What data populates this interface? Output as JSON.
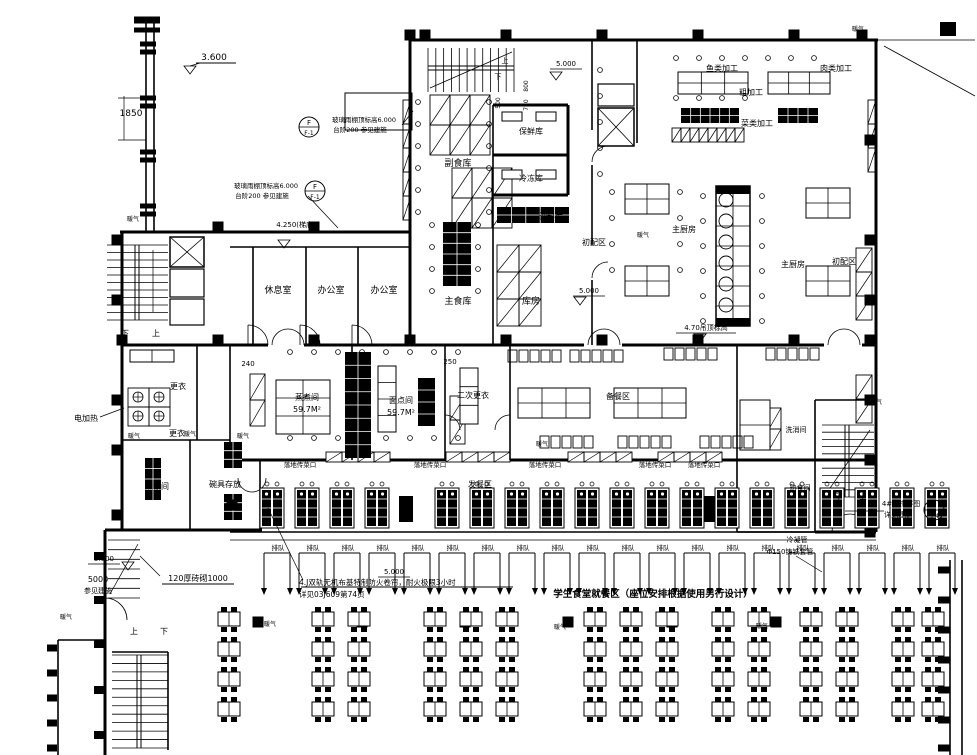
{
  "drawing": {
    "kind": "architectural floor plan (cafeteria / kitchen CAD drawing)",
    "line_color": "#000000",
    "background_color": "#ffffff"
  },
  "notes": {
    "fire_curtain_line1": "4.J双轨无机布基特制防火卷帘，耐火极限3小时",
    "fire_curtain_line2": "详见03J609第74页",
    "dining_area": "学生食堂就餐区（座位安排根据使用另行设计）"
  },
  "symbols": {
    "detail_circles": [
      {
        "top": "F",
        "bottom": "F-1",
        "x": 309,
        "y": 127
      },
      {
        "top": "F",
        "bottom": "F-1",
        "x": 315,
        "y": 191
      },
      {
        "top": "",
        "bottom": "3-4",
        "x": 934,
        "y": 510
      }
    ],
    "level_markers": [
      {
        "x": 190,
        "y": 66
      },
      {
        "x": 556,
        "y": 72
      },
      {
        "x": 580,
        "y": 297
      },
      {
        "x": 700,
        "y": 334
      },
      {
        "x": 128,
        "y": 562
      },
      {
        "x": 284,
        "y": 240
      }
    ]
  },
  "repeated": {
    "queue": {
      "label": "排队",
      "count": 20
    },
    "serving_stations": {
      "count": 19
    },
    "serving_windows": {
      "label": "落地传菜口",
      "count": 5
    },
    "dining_tables": {
      "clusters": 7,
      "rows": 4,
      "seats_per_table": 4
    }
  },
  "labels": [
    {
      "t": "3.600",
      "x": 214,
      "y": 60,
      "s": 9
    },
    {
      "t": "1850",
      "x": 131,
      "y": 116,
      "s": 9
    },
    {
      "t": "玻璃雨棚顶标高6.000",
      "x": 364,
      "y": 122,
      "s": 6.5
    },
    {
      "t": "台阶200  参见建施",
      "x": 360,
      "y": 132,
      "s": 6.5
    },
    {
      "t": "玻璃雨棚顶标高6.000",
      "x": 266,
      "y": 188,
      "s": 6.5
    },
    {
      "t": "台阶200  参见建施",
      "x": 262,
      "y": 198,
      "s": 6.5
    },
    {
      "t": "4.250(梯底)",
      "x": 296,
      "y": 227,
      "s": 7
    },
    {
      "t": "休息室",
      "x": 278,
      "y": 293,
      "s": 9
    },
    {
      "t": "办公室",
      "x": 331,
      "y": 293,
      "s": 9
    },
    {
      "t": "办公室",
      "x": 384,
      "y": 293,
      "s": 9
    },
    {
      "t": "下",
      "x": 125,
      "y": 336,
      "s": 8
    },
    {
      "t": "上",
      "x": 156,
      "y": 336,
      "s": 8
    },
    {
      "t": "副食库",
      "x": 458,
      "y": 166,
      "s": 9
    },
    {
      "t": "保鲜库",
      "x": 531,
      "y": 134,
      "s": 8
    },
    {
      "t": "冷冻库",
      "x": 531,
      "y": 181,
      "s": 8
    },
    {
      "t": "调料库",
      "x": 551,
      "y": 219,
      "s": 8
    },
    {
      "t": "主食库",
      "x": 458,
      "y": 304,
      "s": 9
    },
    {
      "t": "库房",
      "x": 531,
      "y": 304,
      "s": 9
    },
    {
      "t": "上",
      "x": 505,
      "y": 63,
      "s": 7
    },
    {
      "t": "下",
      "x": 498,
      "y": 79,
      "s": 7
    },
    {
      "t": "5.000",
      "x": 566,
      "y": 66,
      "s": 7
    },
    {
      "t": "800",
      "x": 528,
      "y": 86,
      "s": 6,
      "r": -90
    },
    {
      "t": "750",
      "x": 528,
      "y": 105,
      "s": 6,
      "r": -90
    },
    {
      "t": "500",
      "x": 500,
      "y": 103,
      "s": 6,
      "r": -90
    },
    {
      "t": "鱼类加工",
      "x": 722,
      "y": 71,
      "s": 8
    },
    {
      "t": "肉类加工",
      "x": 836,
      "y": 71,
      "s": 8
    },
    {
      "t": "粗加工",
      "x": 751,
      "y": 95,
      "s": 8
    },
    {
      "t": "菜类加工",
      "x": 757,
      "y": 126,
      "s": 8
    },
    {
      "t": "初配区",
      "x": 594,
      "y": 245,
      "s": 8
    },
    {
      "t": "主厨房",
      "x": 684,
      "y": 232,
      "s": 8
    },
    {
      "t": "主厨房",
      "x": 793,
      "y": 267,
      "s": 8
    },
    {
      "t": "初配区",
      "x": 844,
      "y": 264,
      "s": 8
    },
    {
      "t": "5.000",
      "x": 589,
      "y": 293,
      "s": 7
    },
    {
      "t": "4.70吊顶标高",
      "x": 706,
      "y": 330,
      "s": 7
    },
    {
      "t": "240",
      "x": 248,
      "y": 366,
      "s": 7
    },
    {
      "t": "250",
      "x": 450,
      "y": 364,
      "s": 7
    },
    {
      "t": "电加热",
      "x": 86,
      "y": 421,
      "s": 8
    },
    {
      "t": "更衣",
      "x": 178,
      "y": 389,
      "s": 8
    },
    {
      "t": "更衣",
      "x": 177,
      "y": 436,
      "s": 8
    },
    {
      "t": "蒸饭间",
      "x": 157,
      "y": 489,
      "s": 8
    },
    {
      "t": "碗具存放",
      "x": 225,
      "y": 487,
      "s": 8
    },
    {
      "t": "蒸煮间",
      "x": 307,
      "y": 400,
      "s": 8
    },
    {
      "t": "59.7M²",
      "x": 307,
      "y": 412,
      "s": 8
    },
    {
      "t": "面点间",
      "x": 401,
      "y": 403,
      "s": 8
    },
    {
      "t": "59.7M²",
      "x": 401,
      "y": 415,
      "s": 8
    },
    {
      "t": "二次更衣",
      "x": 473,
      "y": 398,
      "s": 8
    },
    {
      "t": "备餐区",
      "x": 618,
      "y": 399,
      "s": 8
    },
    {
      "t": "洗消间",
      "x": 796,
      "y": 432,
      "s": 7
    },
    {
      "t": "熟食间",
      "x": 800,
      "y": 490,
      "s": 7
    },
    {
      "t": "发餐区",
      "x": 480,
      "y": 487,
      "s": 8
    },
    {
      "t": "落地传菜口",
      "x": 300,
      "y": 467,
      "s": 6.5
    },
    {
      "t": "落地传菜口",
      "x": 430,
      "y": 467,
      "s": 6.5
    },
    {
      "t": "落地传菜口",
      "x": 545,
      "y": 467,
      "s": 6.5
    },
    {
      "t": "落地传菜口",
      "x": 655,
      "y": 467,
      "s": 6.5
    },
    {
      "t": "落地传菜口",
      "x": 704,
      "y": 467,
      "s": 6.5
    },
    {
      "t": "下",
      "x": 839,
      "y": 499,
      "s": 7
    },
    {
      "t": "上",
      "x": 863,
      "y": 499,
      "s": 7
    },
    {
      "t": "4#楼梯详图",
      "x": 901,
      "y": 506,
      "s": 7
    },
    {
      "t": "详见建施",
      "x": 898,
      "y": 517,
      "s": 7
    },
    {
      "t": "冷凝管",
      "x": 797,
      "y": 542,
      "s": 7
    },
    {
      "t": "Φ150铸铁套管",
      "x": 790,
      "y": 554,
      "s": 7
    },
    {
      "t": "5.000",
      "x": 104,
      "y": 561,
      "s": 7
    },
    {
      "t": "5000",
      "x": 98,
      "y": 582,
      "s": 8
    },
    {
      "t": "参见建施",
      "x": 98,
      "y": 593,
      "s": 7
    },
    {
      "t": "120厚砖砌1000",
      "x": 198,
      "y": 581,
      "s": 8
    },
    {
      "t": "5.000",
      "x": 394,
      "y": 574,
      "s": 7
    },
    {
      "t": "上",
      "x": 134,
      "y": 634,
      "s": 8
    },
    {
      "t": "下",
      "x": 164,
      "y": 634,
      "s": 8
    },
    {
      "t": "暖气",
      "x": 133,
      "y": 221,
      "s": 6
    },
    {
      "t": "暖气",
      "x": 858,
      "y": 31,
      "s": 6
    },
    {
      "t": "暖气",
      "x": 643,
      "y": 237,
      "s": 6
    },
    {
      "t": "暖气",
      "x": 876,
      "y": 404,
      "s": 6
    },
    {
      "t": "暖气",
      "x": 134,
      "y": 438,
      "s": 6
    },
    {
      "t": "暖气",
      "x": 190,
      "y": 436,
      "s": 6
    },
    {
      "t": "暖气",
      "x": 243,
      "y": 438,
      "s": 6
    },
    {
      "t": "暖气",
      "x": 542,
      "y": 446,
      "s": 6
    },
    {
      "t": "暖气",
      "x": 270,
      "y": 626,
      "s": 6
    },
    {
      "t": "暖气",
      "x": 560,
      "y": 629,
      "s": 6
    },
    {
      "t": "暖气",
      "x": 762,
      "y": 628,
      "s": 6
    },
    {
      "t": "暖气",
      "x": 66,
      "y": 619,
      "s": 6
    }
  ]
}
